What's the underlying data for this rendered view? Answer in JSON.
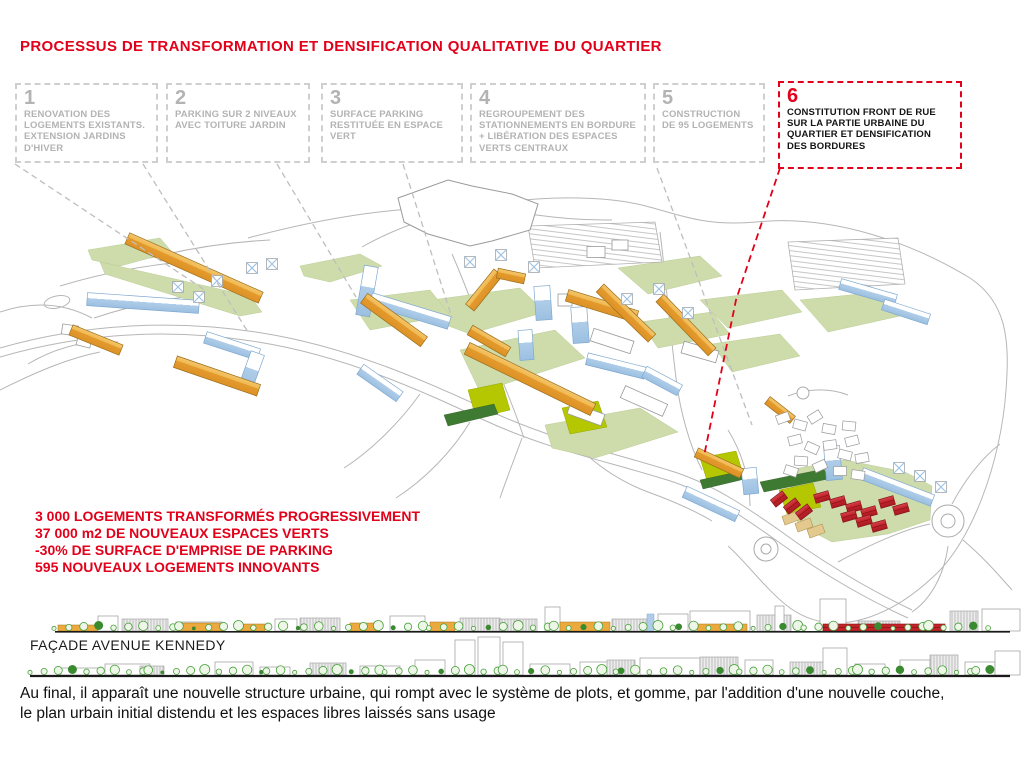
{
  "title": "PROCESSUS DE TRANSFORMATION ET DENSIFICATION QUALITATIVE DU QUARTIER",
  "steps": [
    {
      "num": "1",
      "label": "RENOVATION DES LOGEMENTS EXISTANTS. EXTENSION JARDINS D'HIVER"
    },
    {
      "num": "2",
      "label": "PARKING SUR 2 NIVEAUX AVEC TOITURE JARDIN"
    },
    {
      "num": "3",
      "label": "SURFACE PARKING RESTITUÉE EN ESPACE VERT"
    },
    {
      "num": "4",
      "label": "REGROUPEMENT DES STATIONNEMENTS EN BORDURE + LIBÉRATION DES ESPACES VERTS CENTRAUX"
    },
    {
      "num": "5",
      "label": "CONSTRUCTION DE 95 LOGEMENTS"
    },
    {
      "num": "6",
      "label": "CONSTITUTION FRONT DE RUE SUR LA PARTIE URBAINE DU QUARTIER ET DENSIFICATION DES BORDURES"
    }
  ],
  "stats": [
    "3 000 LOGEMENTS TRANSFORMÉS PROGRESSIVEMENT",
    "37 000 m2 DE NOUVEAUX ESPACES VERTS",
    "-30% DE SURFACE D'EMPRISE DE PARKING",
    "595 NOUVEAUX LOGEMENTS INNOVANTS"
  ],
  "facade": {
    "label": "FAÇADE AVENUE KENNEDY"
  },
  "footer": {
    "line1": "Au final, il apparaît une nouvelle structure urbaine, qui rompt avec le système de plots, et gomme, par l'addition d'une nouvelle couche,",
    "line2": "le plan urbain initial distendu et les espaces libres laissés sans usage"
  },
  "colors": {
    "accent_red": "#E2001A",
    "step_gray": "#B3B3B3",
    "building_orange": "#ECA93D",
    "building_blue": "#AFCDE9",
    "building_red": "#C1232B",
    "green_sage": "#CEDCAC",
    "green_lawn": "#B5C700",
    "green_dark": "#3F7A33"
  }
}
